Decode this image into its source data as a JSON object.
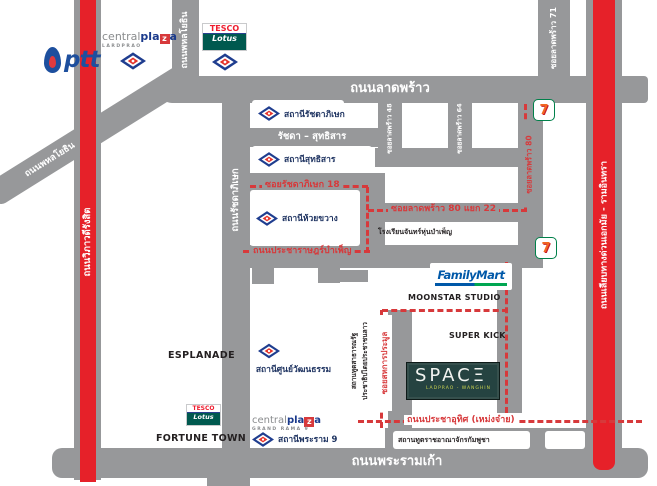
{
  "map": {
    "roads": {
      "ladprao": "ถนนลาดพร้าว",
      "rama9": "ถนนพระรามเก้า",
      "vibhavadi_rangsit": "ถนนวิภาวดีรังสิต",
      "phahonyothin": "ถนนพหลโยธิน",
      "phahonyothin_diagonal": "ถนนพหลโยธิน",
      "ratchadaphisek": "ถนนรัชดาภิเษก",
      "ratchada_sutthisan": "รัชดา – สุทธิสาร",
      "ekkamai_ramindra_expressway": "ถนนเลียบทางด่วนเอกมัย - รามอินทรา",
      "soi_ladprao_71": "ซอยลาดพร้าว 71",
      "soi_ladprao_48": "ซอยลาดพร้าว 48",
      "soi_ladprao_64": "ซอยลาดพร้าว 64",
      "soi_ladprao_80": "ซอยลาดพร้าว 80",
      "soi_ladprao_80_yaek_22": "ซอยลาดพร้าว 80 แยก 22",
      "soi_ratchadaphisek_18": "ซอยรัชดาภิเษก 18",
      "pracharat_bamphen": "ถนนประชาราษฎร์บำเพ็ญ",
      "soi_sahakan_pramun": "ซอยสหการประมูล",
      "pracha_uthit_mengjai": "ถนนประชาอุทิศ (เหม่งจ๋าย)"
    },
    "mrt_stations": {
      "ratchadaphisek": "สถานีรัชดาภิเษก",
      "sutthisan": "สถานีสุทธิสาร",
      "huai_khwang": "สถานีห้วยขวาง",
      "cultural_centre": "สถานีศูนย์วัฒนธรรม",
      "rama9": "สถานีพระราม 9"
    },
    "places": {
      "ptt": "ptt",
      "central_brand": [
        "central",
        "pla",
        "z",
        "a"
      ],
      "central_ladprao_sub": "LARDPRAO",
      "central_rama9_sub": "GRAND RAMA 9",
      "tesco": "TESCO",
      "lotus": "Lotus",
      "esplanade": "ESPLANADE",
      "fortune_town": "FORTUNE TOWN",
      "familymart": "FamilyMart",
      "moonstar_studio": "MOONSTAR STUDIO",
      "super_kick": "SUPER KICK",
      "space_display": "SPACΞ",
      "space_sub": "LADPRAO - WANGHIN",
      "seven_eleven": "7",
      "chanhun_bamphen_school": "โรงเรียนจันทร์หุ่นบำเพ็ญ",
      "lao_embassy_line1": "สถานทูตสาธารณรัฐ",
      "lao_embassy_line2": "ประชาธิปไตยประชาชนลาว",
      "cambodia_embassy": "สถานทูตราชอาณาจักรกัมพูชา"
    },
    "colors": {
      "road_gray": "#97989a",
      "highway_red": "#e62129",
      "route_dash_red": "#d7393b",
      "mrt_navy": "#1f3d8f",
      "mrt_red": "#e6332a",
      "station_text_navy": "#1d3260",
      "space_green": "#254341",
      "familymart_blue": "#0058a8",
      "familymart_green": "#00a651",
      "tesco_red": "#ee1c2e",
      "lotus_teal": "#00594f",
      "ptt_blue": "#1d4f9e",
      "seven_green": "#00804a",
      "seven_orange": "#f26722"
    },
    "icons": [
      "mrt-logo-icon",
      "ptt-flame-icon",
      "seven-eleven-icon",
      "route-dash-line"
    ]
  }
}
